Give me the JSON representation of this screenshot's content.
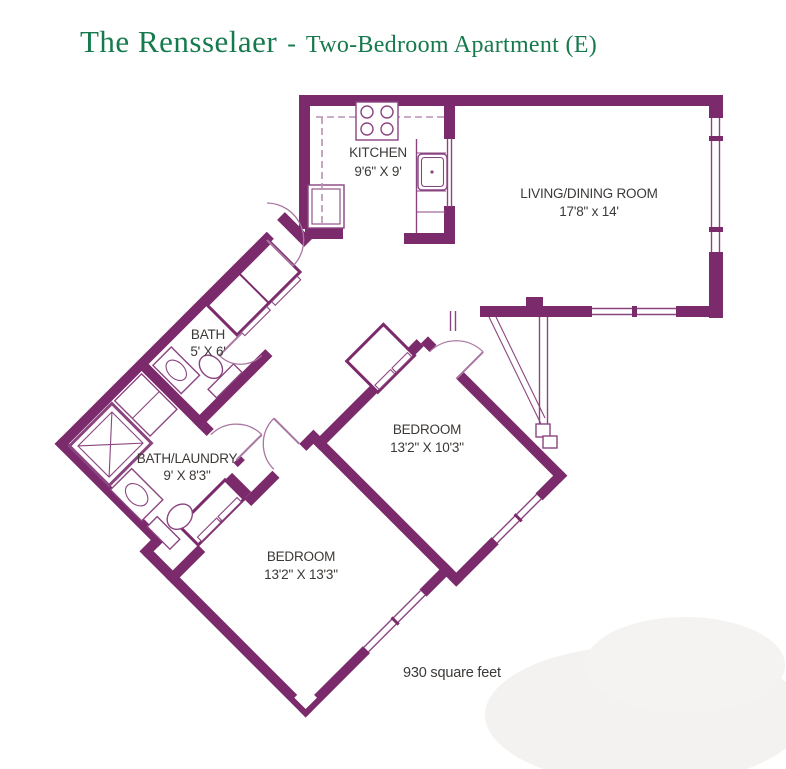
{
  "title": {
    "name": "The Rensselaer",
    "separator": "-",
    "subtitle": "Two-Bedroom Apartment (E)"
  },
  "rooms": {
    "kitchen": {
      "label": "KITCHEN",
      "dims": "9'6\" X 9'"
    },
    "living": {
      "label": "LIVING/DINING ROOM",
      "dims": "17'8\" x 14'"
    },
    "bath": {
      "label": "BATH",
      "dims": "5' X 6'"
    },
    "bath_laundry": {
      "label": "BATH/LAUNDRY",
      "dims": "9' X 8'3\""
    },
    "bedroom_upper": {
      "label": "BEDROOM",
      "dims": "13'2\" X 10'3\""
    },
    "bedroom_lower": {
      "label": "BEDROOM",
      "dims": "13'2\" X 13'3\""
    }
  },
  "footer": {
    "area": "930 square feet"
  },
  "icons": [
    "stove-icon",
    "kitchen-sink-icon",
    "bath-sink-icon",
    "bath-toilet-icon",
    "shower-icon",
    "washer-dryer-icon",
    "laundry-sink-icon",
    "laundry-toilet-icon"
  ],
  "colors": {
    "wall": "#7b2a6b",
    "fixture_line": "#8a4580",
    "dashed_cabinet": "#b791b3",
    "title_green": "#177a4e",
    "label_text": "#3c3937",
    "background": "#ffffff"
  }
}
